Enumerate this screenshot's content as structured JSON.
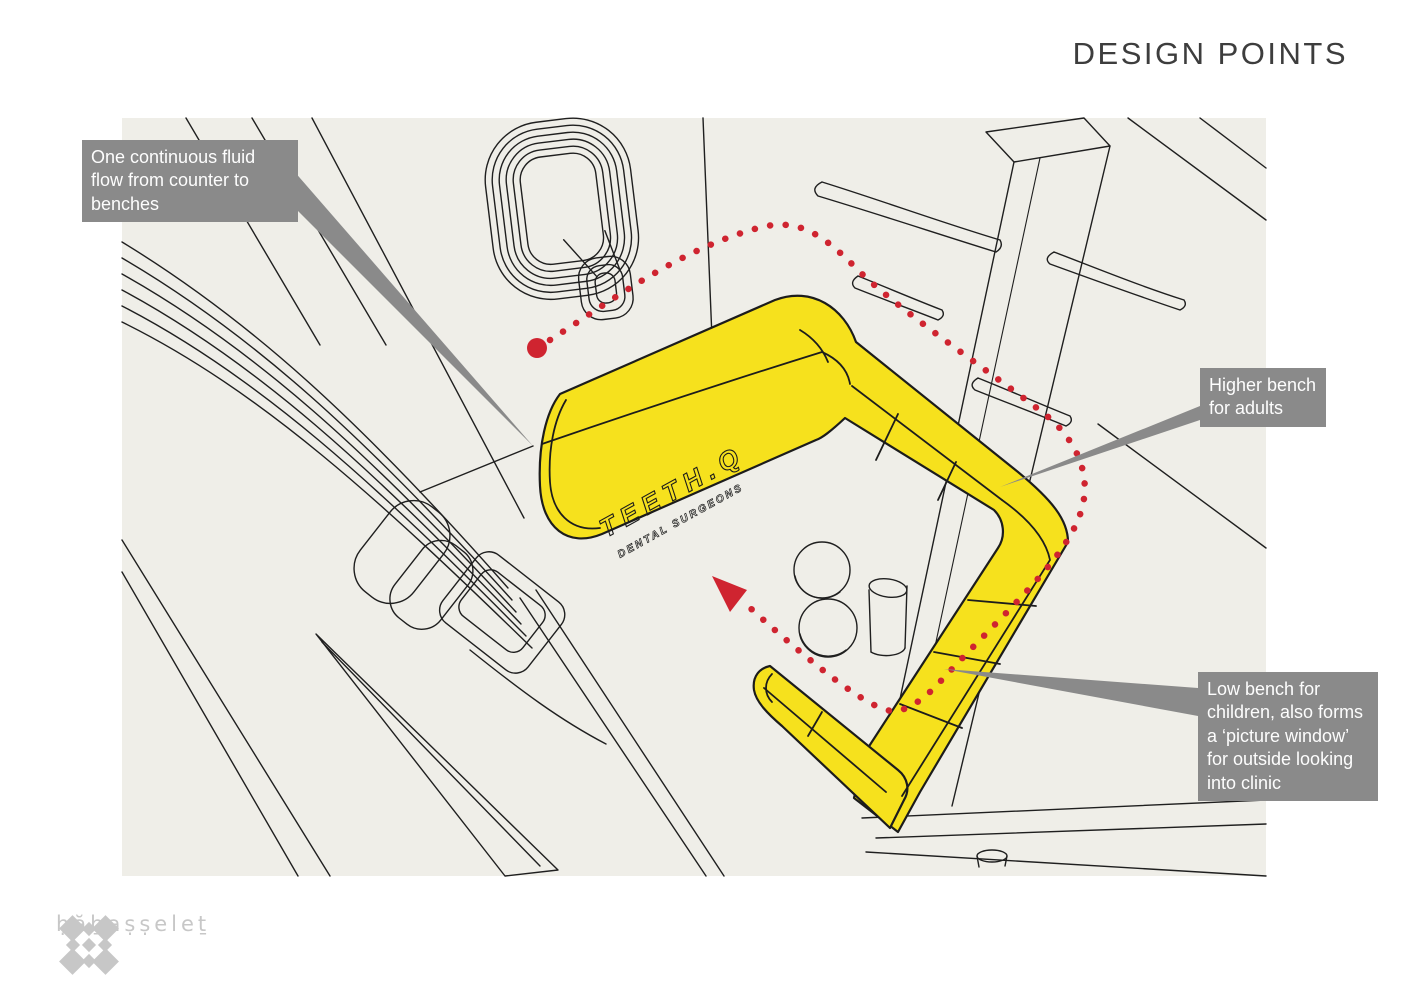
{
  "page": {
    "title": "DESIGN POINTS"
  },
  "callouts": [
    {
      "id": "flow",
      "lines": [
        "One continuous fluid",
        "flow from counter to",
        "benches"
      ]
    },
    {
      "id": "higher-bench",
      "lines": [
        "Higher bench",
        "for adults"
      ]
    },
    {
      "id": "low-bench",
      "lines": [
        "Low bench for",
        "children, also forms",
        "a ‘picture window’",
        "for outside looking",
        "into clinic"
      ]
    }
  ],
  "drawing": {
    "brand_line1": "TEETH.Q",
    "brand_line2": "DENTAL SURGEONS"
  },
  "logo": {
    "text": "ḥăḇaṣṣeleṯ"
  },
  "colors": {
    "paper": "#efeee8",
    "yellow": "#f6e11d",
    "red": "#cf2430",
    "callout": "#8a8a8a",
    "ink": "#1f1f1f",
    "logo": "#c7c7c7",
    "title": "#3d3d3d"
  }
}
